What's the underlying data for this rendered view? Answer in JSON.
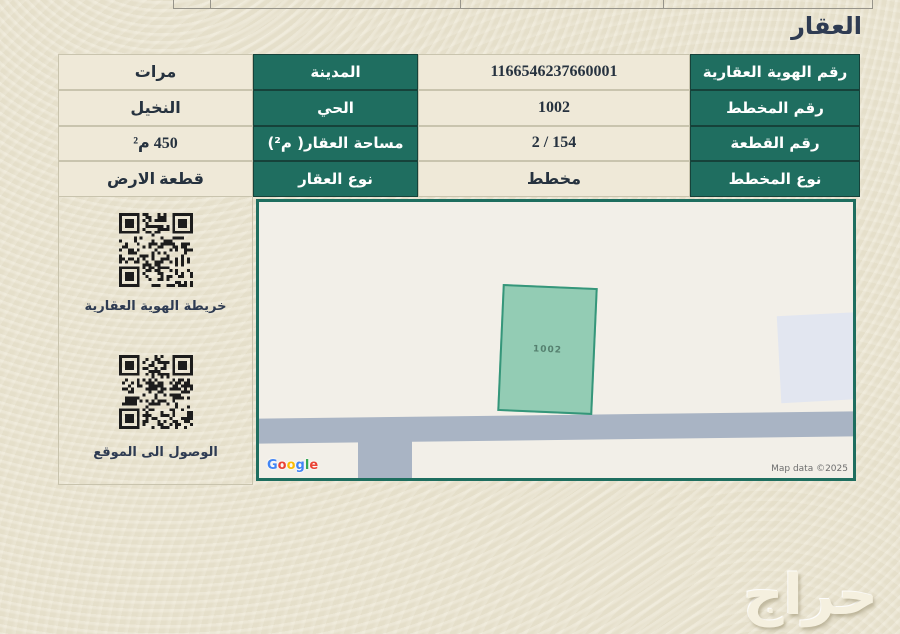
{
  "page": {
    "title": "العقار",
    "background_color": "#ebe5d1",
    "accent_teal": "#1f6e60"
  },
  "property_table": {
    "rows": [
      {
        "label_a": "رقم الهوية العقارية",
        "value_a": "1166546237660001",
        "label_b": "المدينة",
        "value_b": "مرات"
      },
      {
        "label_a": "رقم المخطط",
        "value_a": "1002",
        "label_b": "الحي",
        "value_b": "النخيل"
      },
      {
        "label_a": "رقم القطعة",
        "value_a": "2 / 154",
        "label_b": "مساحة العقار( م²)",
        "value_b": "450 م²"
      },
      {
        "label_a": "نوع المخطط",
        "value_a": "مخطط",
        "label_b": "نوع العقار",
        "value_b": "قطعة الارض"
      }
    ],
    "label_bg": "#1f6e60",
    "label_text_color": "#ffffff",
    "value_text_color": "#26323f"
  },
  "qr_panel": {
    "items": [
      {
        "icon": "qr-code-icon",
        "label": "خريطة الهوية العقارية"
      },
      {
        "icon": "qr-code-icon",
        "label": "الوصول الى الموقع"
      }
    ]
  },
  "map": {
    "parcel_label": "1002",
    "attribution": "Map data ©2025",
    "google_logo_letters": [
      {
        "ch": "G",
        "color": "#4285F4"
      },
      {
        "ch": "o",
        "color": "#EA4335"
      },
      {
        "ch": "o",
        "color": "#FBBC05"
      },
      {
        "ch": "g",
        "color": "#4285F4"
      },
      {
        "ch": "l",
        "color": "#34A853"
      },
      {
        "ch": "e",
        "color": "#EA4335"
      }
    ],
    "colors": {
      "background": "#f2efe8",
      "border": "#1e6e5f",
      "road": "#a9b4c4",
      "parcel_fill": "#93ccb4",
      "parcel_border": "#35967a",
      "neighbor_parcel_fill": "#e2e6f0"
    }
  },
  "watermark": "حراج"
}
